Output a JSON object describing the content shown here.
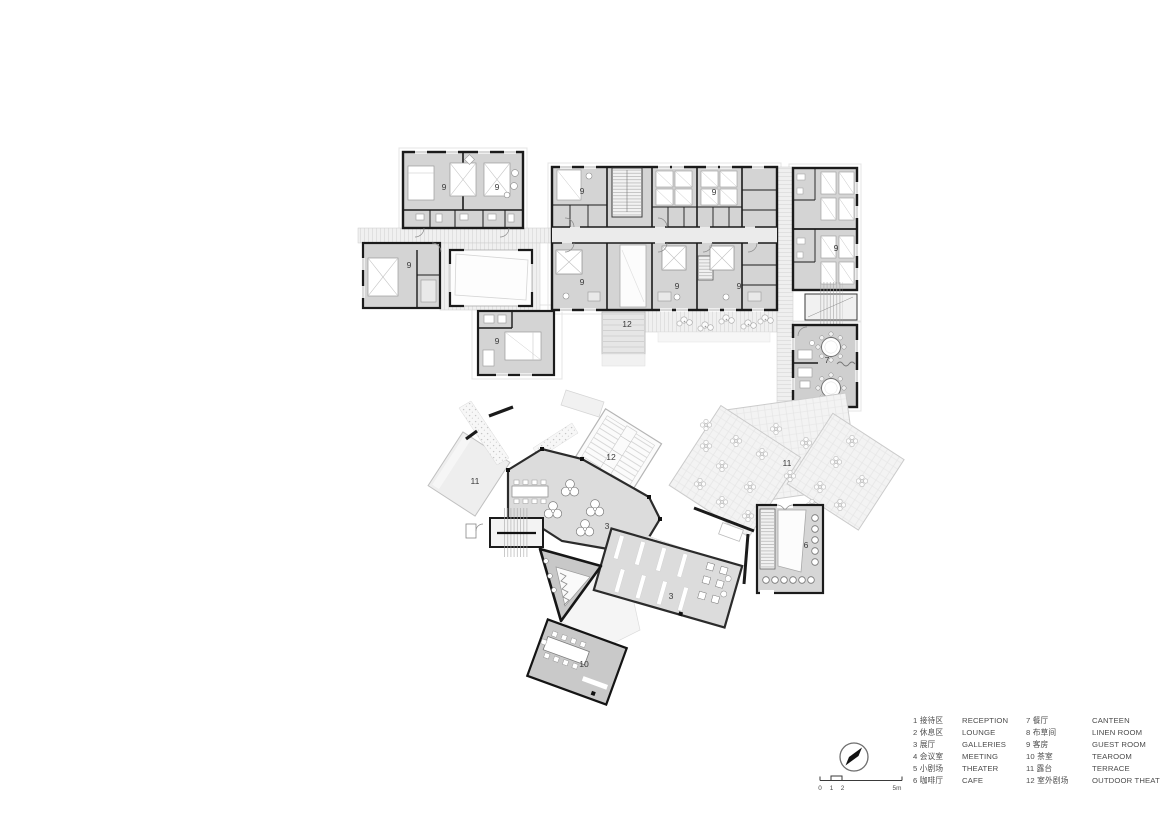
{
  "legend": {
    "items": [
      {
        "no": "1",
        "zh": "接待区",
        "en": "RECEPTION"
      },
      {
        "no": "2",
        "zh": "休息区",
        "en": "LOUNGE"
      },
      {
        "no": "3",
        "zh": "展厅",
        "en": "GALLERIES"
      },
      {
        "no": "4",
        "zh": "会议室",
        "en": "MEETING"
      },
      {
        "no": "5",
        "zh": "小剧场",
        "en": "THEATER"
      },
      {
        "no": "6",
        "zh": "咖啡厅",
        "en": "CAFE"
      },
      {
        "no": "7",
        "zh": "餐厅",
        "en": "CANTEEN"
      },
      {
        "no": "8",
        "zh": "布草间",
        "en": "LINEN ROOM"
      },
      {
        "no": "9",
        "zh": "客房",
        "en": "GUEST ROOM"
      },
      {
        "no": "10",
        "zh": "茶室",
        "en": "TEAROOM"
      },
      {
        "no": "11",
        "zh": "露台",
        "en": "TERRACE"
      },
      {
        "no": "12",
        "zh": "室外剧场",
        "en": "OUTDOOR THEATER"
      }
    ]
  },
  "scale_bar": {
    "labels": [
      "0",
      "1",
      "2",
      "5m"
    ]
  },
  "plan": {
    "room_labels": [
      {
        "text": "9",
        "x": 444,
        "y": 190
      },
      {
        "text": "9",
        "x": 497,
        "y": 190
      },
      {
        "text": "9",
        "x": 582,
        "y": 194
      },
      {
        "text": "9",
        "x": 714,
        "y": 195
      },
      {
        "text": "9",
        "x": 836,
        "y": 251
      },
      {
        "text": "9",
        "x": 409,
        "y": 268
      },
      {
        "text": "9",
        "x": 582,
        "y": 285
      },
      {
        "text": "9",
        "x": 677,
        "y": 289
      },
      {
        "text": "9",
        "x": 739,
        "y": 289
      },
      {
        "text": "9",
        "x": 497,
        "y": 344
      },
      {
        "text": "12",
        "x": 627,
        "y": 327
      },
      {
        "text": "7",
        "x": 827,
        "y": 363
      },
      {
        "text": "12",
        "x": 611,
        "y": 460
      },
      {
        "text": "11",
        "x": 475,
        "y": 484
      },
      {
        "text": "11",
        "x": 787,
        "y": 466
      },
      {
        "text": "3",
        "x": 607,
        "y": 529
      },
      {
        "text": "3",
        "x": 671,
        "y": 599
      },
      {
        "text": "6",
        "x": 806,
        "y": 548
      },
      {
        "text": "10",
        "x": 584,
        "y": 667
      }
    ]
  },
  "colors": {
    "wall": "#1b1b1b",
    "room_fill": "#d4d4d4",
    "terrace_fill": "#f3f3f3",
    "label_text": "#3c3c3c",
    "legend_text": "#4c4c4c"
  }
}
